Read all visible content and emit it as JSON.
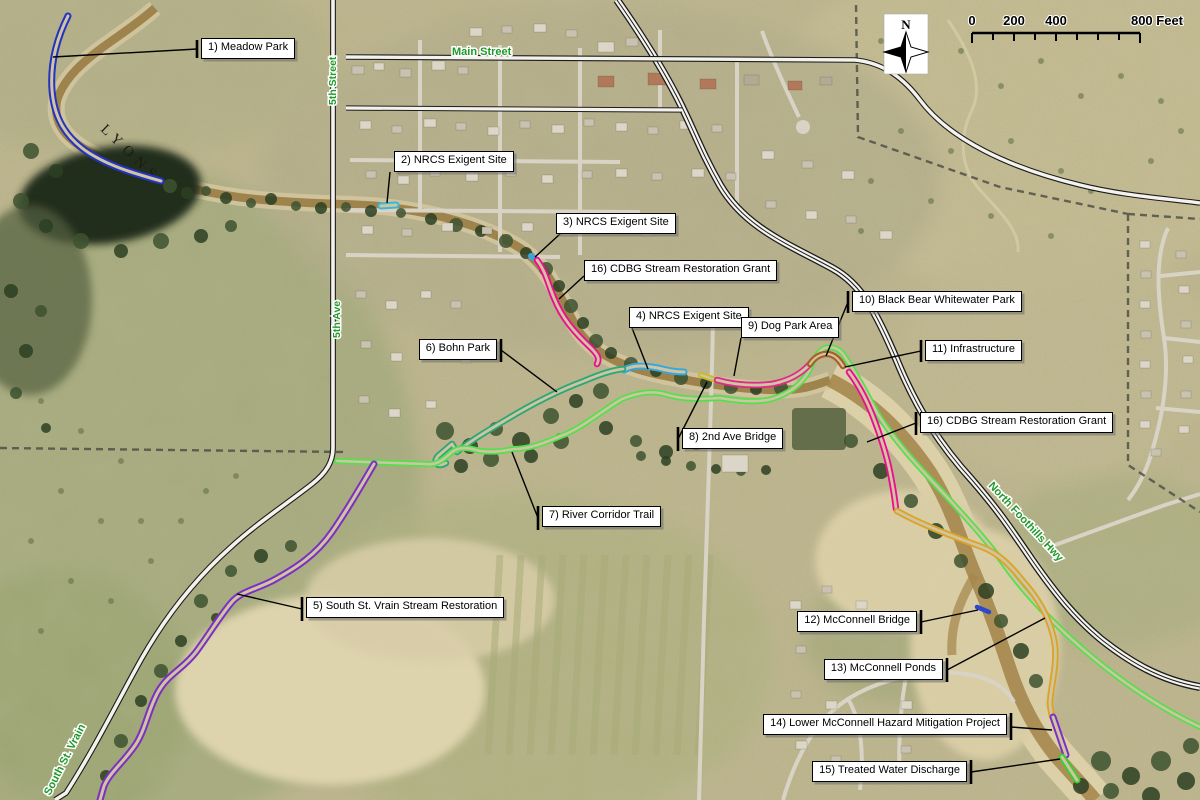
{
  "callouts": [
    {
      "id": "meadow-park",
      "label": "1) Meadow Park"
    },
    {
      "id": "nrcs-exigent-2",
      "label": "2) NRCS Exigent Site"
    },
    {
      "id": "nrcs-exigent-3",
      "label": "3) NRCS Exigent Site"
    },
    {
      "id": "cdbg-grant-west",
      "label": "16) CDBG Stream Restoration Grant"
    },
    {
      "id": "nrcs-exigent-4",
      "label": "4) NRCS Exigent Site"
    },
    {
      "id": "dog-park-area",
      "label": "9) Dog Park Area"
    },
    {
      "id": "black-bear-whitewater",
      "label": "10) Black Bear Whitewater Park"
    },
    {
      "id": "infrastructure",
      "label": "11) Infrastructure"
    },
    {
      "id": "bohn-park",
      "label": "6) Bohn Park"
    },
    {
      "id": "cdbg-grant-east",
      "label": "16) CDBG Stream Restoration Grant"
    },
    {
      "id": "second-ave-bridge",
      "label": "8) 2nd Ave Bridge"
    },
    {
      "id": "river-corridor-trail",
      "label": "7) River Corridor Trail"
    },
    {
      "id": "south-st-vrain-restoration",
      "label": "5) South St. Vrain Stream Restoration"
    },
    {
      "id": "mcconnell-bridge",
      "label": "12) McConnell Bridge"
    },
    {
      "id": "mcconnell-ponds",
      "label": "13) McConnell Ponds"
    },
    {
      "id": "lower-mcconnell",
      "label": "14) Lower McConnell Hazard Mitigation Project"
    },
    {
      "id": "treated-water",
      "label": "15)  Treated Water Discharge"
    }
  ],
  "streets": [
    {
      "id": "main-street",
      "label": "Main Street"
    },
    {
      "id": "fifth-street",
      "label": "5th Street"
    },
    {
      "id": "fifth-ave",
      "label": "5th Ave"
    },
    {
      "id": "north-foothills-hwy",
      "label": "North Foothills Hwy"
    },
    {
      "id": "south-st-vrain",
      "label": "South St. Vrain"
    }
  ],
  "street_label_color": "#1f9a28",
  "place_labels": [
    {
      "id": "lyons",
      "label": "LYONS"
    }
  ],
  "compass": {
    "north_label": "N"
  },
  "scale_bar": {
    "labels": [
      "0",
      "200",
      "400"
    ],
    "end_label": "800 Feet"
  },
  "routes": [
    {
      "id": "meadow-park-route",
      "color": "#2433c0"
    },
    {
      "id": "nrcs-site-2",
      "color": "#38b8d8"
    },
    {
      "id": "nrcs-site-3",
      "color": "#38a8dc"
    },
    {
      "id": "cdbg-reach-west",
      "color": "#ee0c90"
    },
    {
      "id": "nrcs-site-4",
      "color": "#38a8dc"
    },
    {
      "id": "bohn-park-reach",
      "color": "#2ca878"
    },
    {
      "id": "river-corridor-trail",
      "color": "#52e14c"
    },
    {
      "id": "second-ave-bridge-seg",
      "color": "#c9bb2a"
    },
    {
      "id": "dog-park-reach",
      "color": "#df2a88"
    },
    {
      "id": "whitewater-park-seg",
      "color": "#a95f28"
    },
    {
      "id": "cdbg-reach-east",
      "color": "#ee0c90"
    },
    {
      "id": "mcconnell-reach",
      "color": "#dba424"
    },
    {
      "id": "mcconnell-bridge-seg",
      "color": "#2948cc"
    },
    {
      "id": "lower-mcconnell-seg",
      "color": "#7d2fc4"
    },
    {
      "id": "treated-water-seg",
      "color": "#3ecc35"
    },
    {
      "id": "south-st-vrain-reach",
      "color": "#7d2fc4"
    }
  ]
}
